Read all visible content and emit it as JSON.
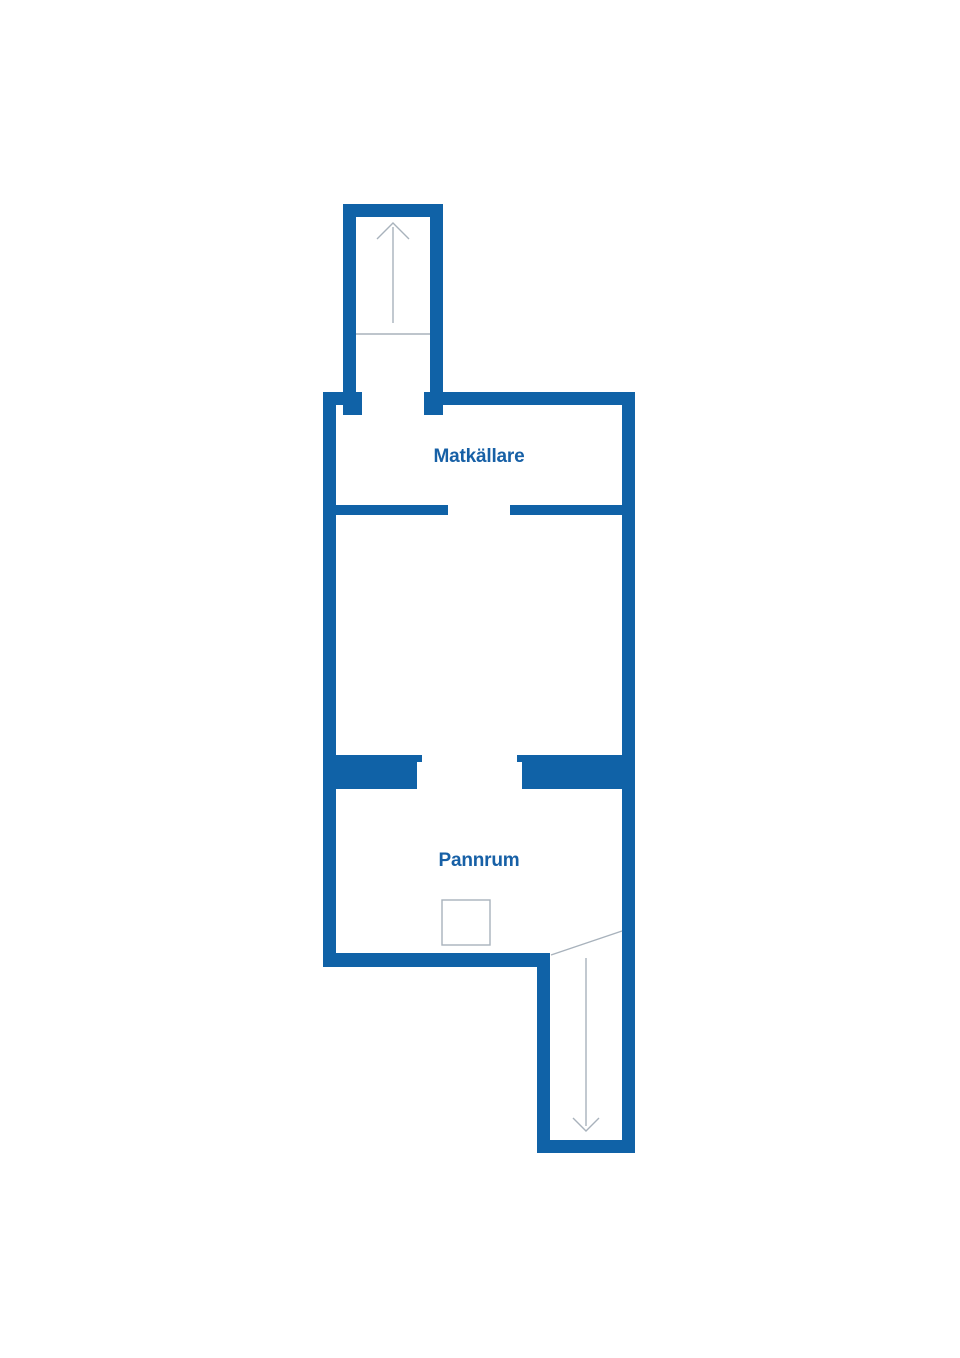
{
  "title": "Basement floor plan",
  "rooms": [
    {
      "id": "matkallare",
      "label": "Matkällare"
    },
    {
      "id": "pannrum",
      "label": "Pannrum"
    }
  ],
  "stairs": [
    {
      "id": "stairs-up",
      "direction": "up",
      "icon": "arrow-up-icon"
    },
    {
      "id": "stairs-down",
      "direction": "down",
      "icon": "arrow-down-icon"
    }
  ],
  "fixtures": [
    {
      "id": "boiler",
      "shape": "square-outline"
    }
  ],
  "colors": {
    "wall": "#1062a7",
    "label": "#1760a6",
    "line": "#a8b2bc",
    "bg": "#ffffff"
  }
}
